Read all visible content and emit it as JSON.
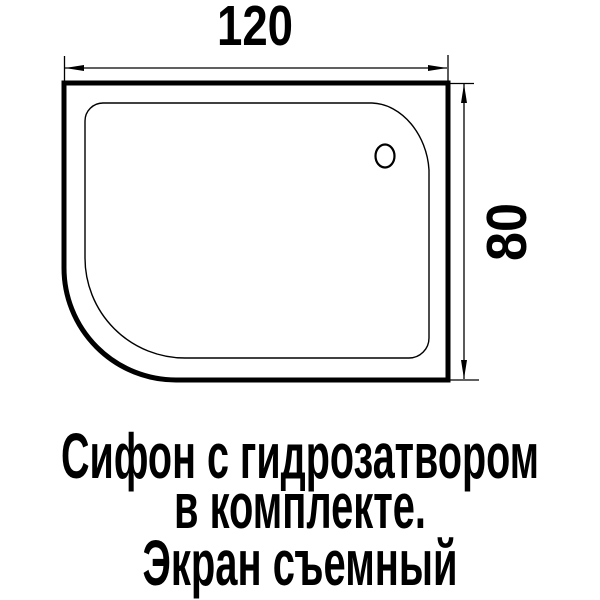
{
  "diagram": {
    "dimensions": {
      "width_label": "120",
      "height_label": "80"
    },
    "caption": {
      "line1": "Сифон с гидрозатвором",
      "line2": "в комплекте.",
      "line3": "Экран съемный"
    },
    "colors": {
      "line": "#000000",
      "background": "#ffffff"
    }
  }
}
